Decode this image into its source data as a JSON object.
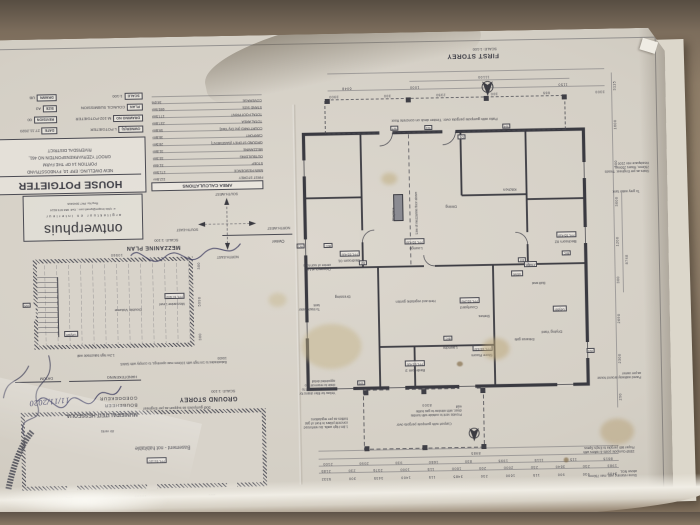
{
  "palette": {
    "table_brown": "#8d7c67",
    "paper": "#d6d1c8",
    "ink": "#3d3d45",
    "stain_yellow": "#c4b183",
    "pen_blue": "#3a3a5e"
  },
  "plan_titles": {
    "first_storey": "FIRST STOREY",
    "first_storey_scale": "SCALE: 1:100",
    "mezzanine_plan": "MEZZANINE PLAN",
    "mezzanine_scale": "SCALE: 1:100",
    "ground_storey": "GROUND STOREY",
    "ground_scale": "SCALE: 1:100"
  },
  "title_block": {
    "col_a": [
      {
        "label": "OWNER(S)",
        "value": "L POTGIETER"
      },
      {
        "label": "DRAWING NO",
        "value": "M-102-POTGIETER"
      },
      {
        "label": "PLAN",
        "value": "COUNCIL SUBMISSION"
      },
      {
        "label": "SCALE",
        "value": "1:100"
      }
    ],
    "col_b": [
      {
        "label": "DATE",
        "value": "27.11.2020"
      },
      {
        "label": "REVISION",
        "value": "00"
      },
      {
        "label": "SIZE",
        "value": "A3"
      },
      {
        "label": "DRAWN",
        "value": "UB"
      }
    ]
  },
  "project": {
    "title": "HOUSE POTGIETER",
    "line1": "NEW DWELLING: ERF 10, FYNBOSSTRAND",
    "line2": "PORTION 14 OF THE FARM",
    "line3": "GROOT YZERVARKENSFONTEIN NO 461,",
    "line4": "RIVERSDAL DISTRICT"
  },
  "firm": {
    "name": "ontwerphuis",
    "tagline": "argitektuur en interieur",
    "contact": "e: rykie.kruger@gmail.com ; Cell: 083 973 8114",
    "reg": "Reg No: PA7 3043416",
    "owner_label": "Owner"
  },
  "stamp": {
    "municipality": "MUNISIPALITEIT HESSEQUA",
    "dept": "BOUBEHEER",
    "approved": "GOEDGEKEUR",
    "date_label": "DATUM",
    "signature_label": "HANDTEKENING",
    "handwritten_date": "11/11/2020"
  },
  "area_calculations": {
    "title": "AREA CALCULATIONS",
    "rows": [
      {
        "name": "FIRST STOREY",
        "value": "112.8m²"
      },
      {
        "name": "MAIN RESIDENCE",
        "value": "171.5m²"
      },
      {
        "name": "STOEP",
        "value": "31.4m²"
      },
      {
        "name": "OUTBUILDING",
        "value": "33.3m²"
      },
      {
        "name": "MEZZANINE",
        "value": "31.8m²"
      },
      {
        "name": "GROUND STOREY (BASEMENT)",
        "value": "28.5m²"
      },
      {
        "name": "CARPORT",
        "value": "36.8m²"
      },
      {
        "name": "COURTYARD (inc Dry Yard)",
        "value": "59.8m²"
      },
      {
        "name": "TOTAL AREA",
        "value": "237.8m²"
      },
      {
        "name": "TOTAL FOOTPRINT",
        "value": "177.5m²"
      },
      {
        "name": "STAND SIZE",
        "value": "695.9m²"
      },
      {
        "name": "COVERAGE",
        "value": "34.6%"
      }
    ]
  },
  "compass": {
    "top": "NORTH-EAST",
    "bottom": "SOUTH-WEST",
    "left": "NORTH-WEST",
    "right": "SOUTH-EAST"
  },
  "rooms": {
    "lounge": "Lounge",
    "dining": "Dining",
    "kitchen": "Kitchen",
    "bedroom1": "Bedroom 01",
    "bedroom2": "Bedroom 02",
    "bedroom3": "Bedroom 3",
    "dressing": "Dressing",
    "laundry": "Laundry",
    "store_room": "Store Room",
    "courtyard": "Courtyard",
    "herb_garden": "Herb and vegetable garden",
    "drying_yard": "Drying Yard",
    "fireplace": "Fireplace",
    "stove": "Stove",
    "fridge": "Fridge",
    "geyser": "Geyser",
    "built_seat": "Built seat",
    "shelves": "Shelves",
    "entrance_gate": "Entrance gate",
    "double_volume": "Double Volume",
    "mezzanine_level": "Mezzanine Level",
    "basement": "Basement - not habitable",
    "air_vents": "Air vents",
    "bic": "BIC"
  },
  "levels": {
    "ffl_main": "FFL 65.430",
    "ffl_courtyard": "FFL 65.240",
    "ffl_mezzanine": "FFL 67.600",
    "ffl_basement": "FFL 63.110"
  },
  "tags": {
    "w1": "W1",
    "w2": "W2",
    "w3": "W3",
    "w4": "W4",
    "w5": "W5",
    "w6": "W6",
    "w7": "W7",
    "d1": "D1",
    "d2": "D2",
    "d3": "D3"
  },
  "notes": {
    "patio": "Patio with gumpole pergola over. Timber deck on concrete floor.",
    "carport": "Carport with gumpole pergola over",
    "balustrade": "Balustrades to 1m high with 100mm max openings, to comply with SANS 10400",
    "balustrade_wall": "1.2m high balustrade wall",
    "stairs": "Stairs as per Engineer. Treads 250mm, Risers 250mm. Headspace min 2100",
    "grey_water": "To grey water tank",
    "black_water": "To black water tank",
    "filter_drains": "Yellow for filter drains for rainwater catchment to drain to reservoir - to appointed detail",
    "gas_walls": "1.8m High walls. As reinforced concrete pillars in front of gas bottles as per regulations",
    "laundry_vent": "Provide vent to outside with tumble dryer, with window to gas bottle wall",
    "pergola_posts": "150Ø Gumpole posts & rafters with Floper lath pergola to Eng's Specs",
    "walkway": "Paved walkway around house as per owner",
    "retaining": "Stone retaining wall, max 750mm above NGL",
    "chimney": "Chimney's at 1m centre of roof ridge",
    "gumpole_support": "50Ø gumpoles as support as per Engineer",
    "mezz_line": "Line of mezzanine floor above"
  },
  "dims": {
    "south_row1": [
      "3409",
      "930",
      "900",
      "115",
      "1600",
      "230",
      "3485",
      "115",
      "1400",
      "3435",
      "300",
      "5332"
    ],
    "south_row2": [
      "1983",
      "230",
      "3640",
      "230",
      "2000",
      "200",
      "1600",
      "115",
      "1000",
      "2376",
      "230",
      "2185"
    ],
    "south_row3": [
      "8615",
      "115",
      "1115",
      "1995",
      "830",
      "1680",
      "930",
      "2090",
      "2100"
    ],
    "south_total": "8985",
    "carport_width": "8300",
    "north_row1": [
      "3300",
      "665",
      "300",
      "2350",
      "300",
      "3900"
    ],
    "north_row2": [
      "1150",
      "1235",
      "1000"
    ],
    "north_sub": "6048",
    "north_total": "11100",
    "east_chain": [
      "290",
      "2300",
      "2690",
      "300",
      "1200",
      "3600",
      "300",
      "1600",
      "3115"
    ],
    "east_total": "8748",
    "mezz_side": [
      "300",
      "5990",
      "300"
    ],
    "mezz_total": "10560",
    "basement_row": [
      "300",
      "10500",
      "300"
    ],
    "basement_total": "11100"
  }
}
